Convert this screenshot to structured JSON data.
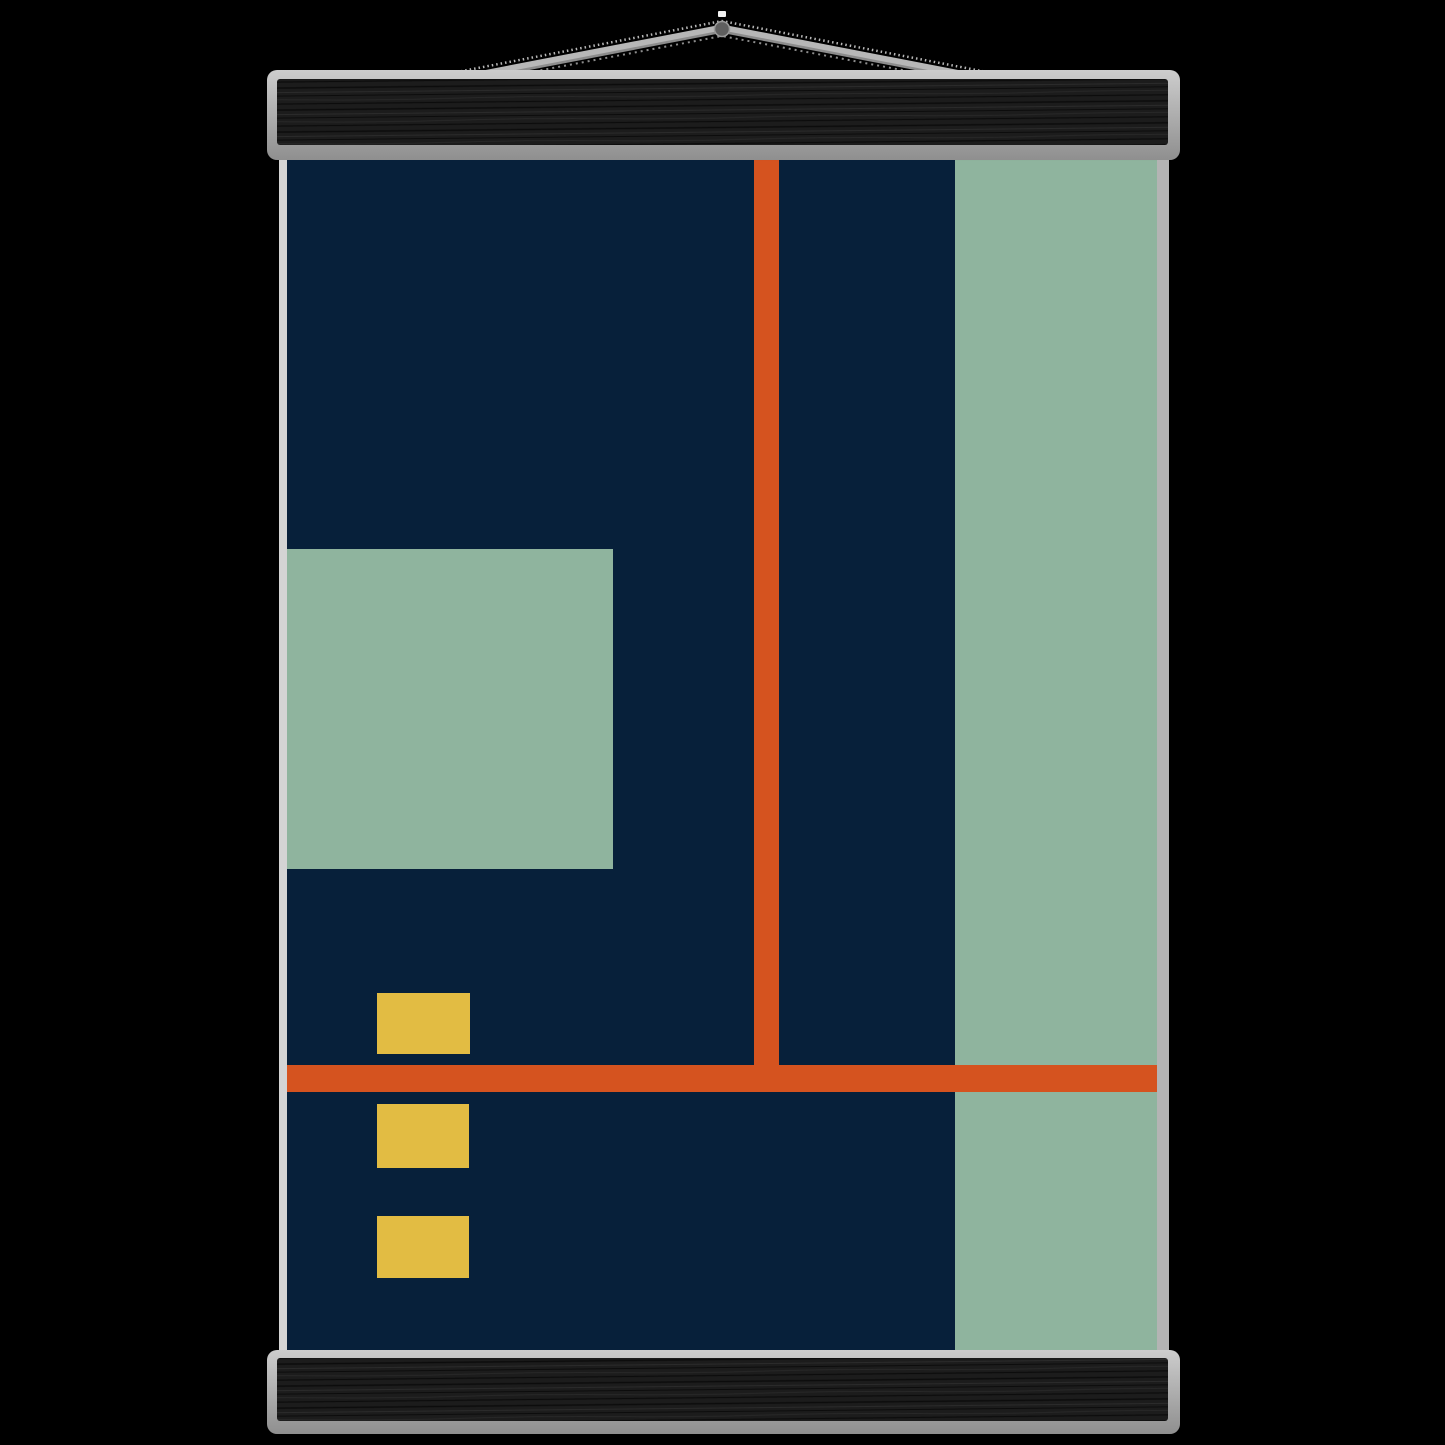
{
  "scene": {
    "description": "Abstract geometric Bauhaus-style art print hung on black wooden magnetic poster hangers with a grey cord on a black background",
    "background_color": "#000000"
  },
  "hanger": {
    "wood_color": "#1c1c1c",
    "grain_dark": "#0c0c0c",
    "grain_light": "#2b2b2b",
    "rail_light": "#cdcdcd",
    "rail_dark": "#8f8f8f",
    "edge_left": "#d4d4d4",
    "edge_right": "#b4b4b4",
    "cord": {
      "light": "#b7b7b7",
      "dark": "#8c8c8c",
      "ring": "#5f5f5f",
      "ring_rim": "#9a9a9a",
      "nail": "#f2f2f2"
    }
  },
  "artwork": {
    "palette": {
      "navy": "#07203a",
      "sage": "#8fb49e",
      "orange": "#d5531f",
      "yellow": "#e2bc43"
    },
    "shapes": [
      {
        "name": "canvas-background",
        "x": 287,
        "y": 146,
        "w": 870,
        "h": 1212,
        "color": "navy"
      },
      {
        "name": "right-green-band",
        "x": 955,
        "y": 146,
        "w": 202,
        "h": 1212,
        "color": "sage"
      },
      {
        "name": "left-green-square",
        "x": 287,
        "y": 549,
        "w": 326,
        "h": 320,
        "color": "sage"
      },
      {
        "name": "vertical-orange-line",
        "x": 754,
        "y": 146,
        "w": 25,
        "h": 919,
        "color": "orange"
      },
      {
        "name": "horizontal-orange-line",
        "x": 287,
        "y": 1065,
        "w": 870,
        "h": 27,
        "color": "orange"
      },
      {
        "name": "yellow-block-top",
        "x": 377,
        "y": 993,
        "w": 93,
        "h": 61,
        "color": "yellow"
      },
      {
        "name": "yellow-block-middle",
        "x": 377,
        "y": 1104,
        "w": 92,
        "h": 64,
        "color": "yellow"
      },
      {
        "name": "yellow-block-bottom",
        "x": 377,
        "y": 1216,
        "w": 92,
        "h": 62,
        "color": "yellow"
      }
    ]
  }
}
